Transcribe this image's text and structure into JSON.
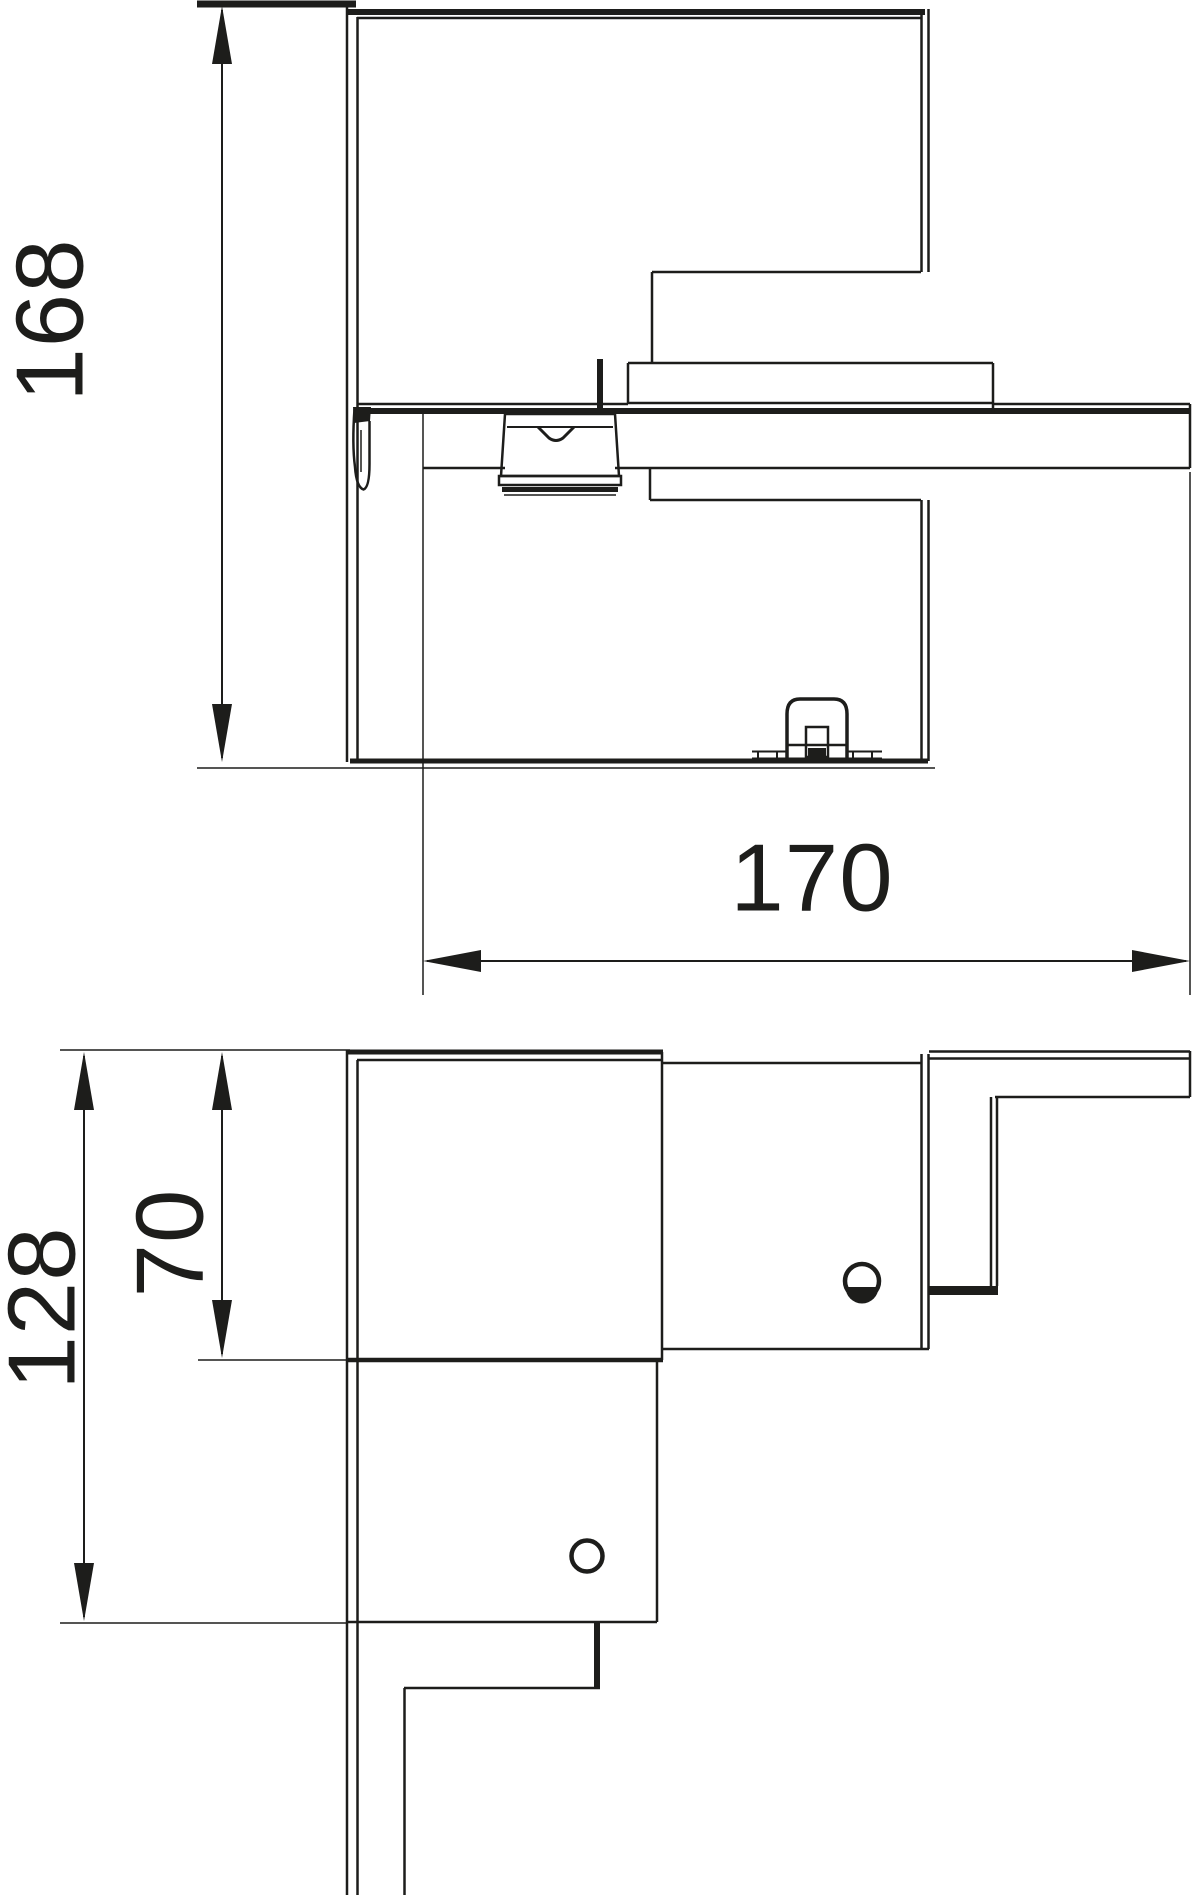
{
  "drawing": {
    "background": "#ffffff",
    "line_color": "#1d1d1b",
    "views": {
      "top_view": {
        "dimensions": {
          "height": {
            "value": "168",
            "orientation": "vertical"
          },
          "width": {
            "value": "170",
            "orientation": "horizontal"
          }
        }
      },
      "bottom_view": {
        "dimensions": {
          "overall_height": {
            "value": "128",
            "orientation": "vertical"
          },
          "upper_height": {
            "value": "70",
            "orientation": "vertical"
          }
        }
      }
    }
  }
}
